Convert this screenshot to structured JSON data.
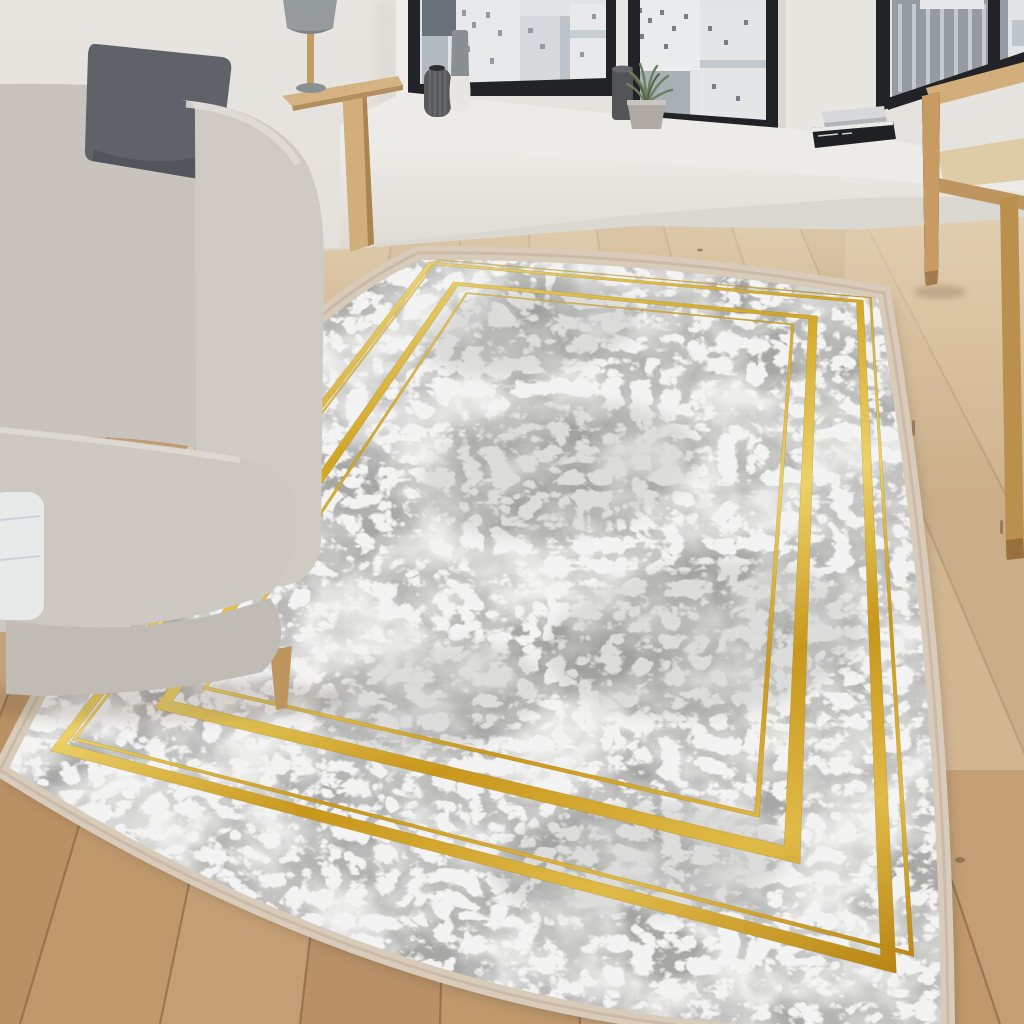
{
  "scene": {
    "title": "Living room photo: grey marble-pattern area rug with gold rectangular frame borders on a rustic wooden plank floor",
    "objects": {
      "sofa": "light grey fabric sofa",
      "pillow": "dark grey cushion",
      "throw": "white cushion on seat",
      "side_table": "light wood console table",
      "lamp": "table lamp with grey cylindrical shade",
      "windows": "black framed windows with greyscale city view",
      "bench": "white window seat bench",
      "plant": "potted green plant",
      "vases": "decorative vases",
      "books": "stacked books on sill",
      "chair": "light wood armchair",
      "floor": "rustic oak plank floor",
      "rug": "grey marble rug with double gold line frames and cream edge"
    }
  },
  "colors": {
    "wall": "#ebe8e3",
    "wall_shade": "#ddd8d0",
    "window_frame": "#232528",
    "sky": "#e9ecee",
    "city_light": "#eff1f2",
    "city_mid": "#b9c0c6",
    "city_dark": "#6e757c",
    "bench_top": "#f5f3ef",
    "bench_face": "#efece6",
    "bench_wall": "#e3dfd8",
    "floor_base": "#c69e70",
    "floor_seam": "#7e5c3b",
    "floor_wash": "#f0e2c4",
    "sofa_body": "#d6d2cb",
    "sofa_dark": "#c7c2bb",
    "pillow": "#63666d",
    "throw": "#f0f2f1",
    "wood_light": "#d9b57e",
    "wood_mid": "#c59a62",
    "rug_border": "#e0d2c0",
    "marble_base": "#dadad8",
    "gold_hi": "#f3dc82",
    "gold_mid": "#d9ab26",
    "gold_deep": "#b9830e",
    "plant_green": "#6f8360",
    "pot_grey": "#b5b1aa",
    "vase_dark": "#5b5c5e",
    "vase_white": "#f0eeea",
    "lamp_shade": "#9ba1a3",
    "book_dark": "#202225",
    "book_light": "#dddfe0"
  }
}
